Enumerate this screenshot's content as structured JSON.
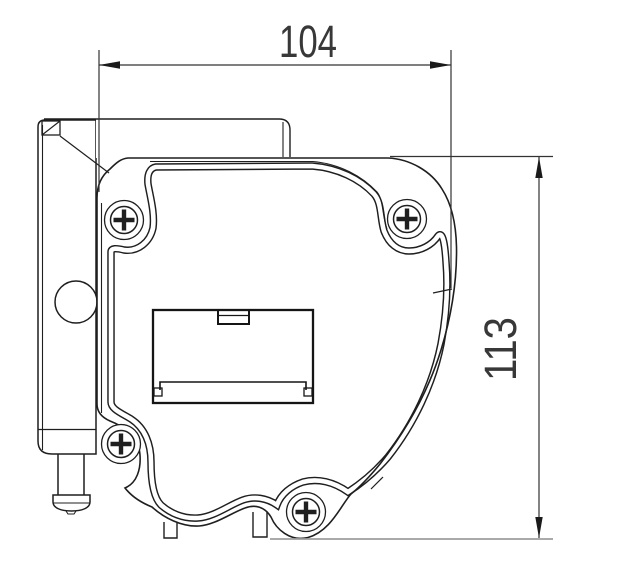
{
  "page": {
    "width": 623,
    "height": 565,
    "background": "#ffffff"
  },
  "drawing": {
    "kind": "technical-drawing",
    "subject": "roller-blind motor housing side view with mounting bracket",
    "colors": {
      "line": "#1f1f1f",
      "dimension_line": "#333333",
      "gray_extension": "#9e9e9e",
      "text": "#383838",
      "background": "#ffffff"
    },
    "dimensions": {
      "width": {
        "label": "104",
        "orientation": "horizontal"
      },
      "height": {
        "label": "113",
        "orientation": "vertical"
      }
    },
    "features": {
      "screw_count": 4,
      "has_battery_cover": true,
      "has_bracket_hole": true,
      "has_mounting_pin": true
    }
  }
}
